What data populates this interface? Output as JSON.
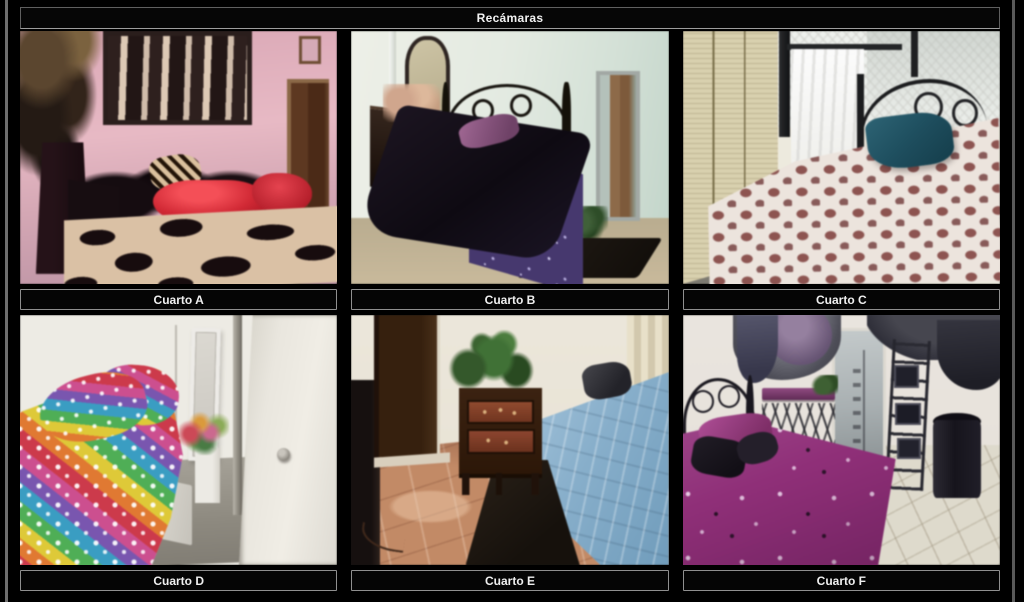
{
  "header": {
    "title": "Recámaras"
  },
  "rooms": [
    {
      "id": "A",
      "label": "Cuarto A",
      "photo_alt": "bedroom with pink walls, zebra-print wall art, dark plant, brown door, black pillows, red bolster pillow and black-and-cream print blanket"
    },
    {
      "id": "B",
      "label": "Cuarto B",
      "photo_alt": "bedroom with pale green walls, dark wood dresser with ornate mirror and flowers, black iron bed with dark comforter, purple pillow and purple bed skirt, standing mirror and dark rugs"
    },
    {
      "id": "C",
      "label": "Cuarto C",
      "photo_alt": "bedroom with cream louvered closet doors, window with white lace and sheer curtains, black iron headboard, white bedspread with mauve squares and a dark teal pillow"
    },
    {
      "id": "D",
      "label": "Cuarto D",
      "photo_alt": "bedroom with white walls, bed with rainbow polka-dot comforter and pillows, leaning mirror, flowers on a white pedestal and an open white door"
    },
    {
      "id": "E",
      "label": "Cuarto E",
      "photo_alt": "bedroom with terracotta tile floor, dark brown door, wooden nightstand with green plant, dark rug and a light blue bed with a dark pillow"
    },
    {
      "id": "F",
      "label": "Cuarto F",
      "photo_alt": "bedroom with purple floral bedspread, black iron headboard, purple and gray drapes, mirror, metal ladder décor with frames and a black barrel hamper"
    }
  ],
  "colors": {
    "background": "#000000",
    "side_rule": "#6f6f6f",
    "label_border": "#8f8f8f",
    "label_background": "#050505",
    "label_text": "#efefef"
  }
}
